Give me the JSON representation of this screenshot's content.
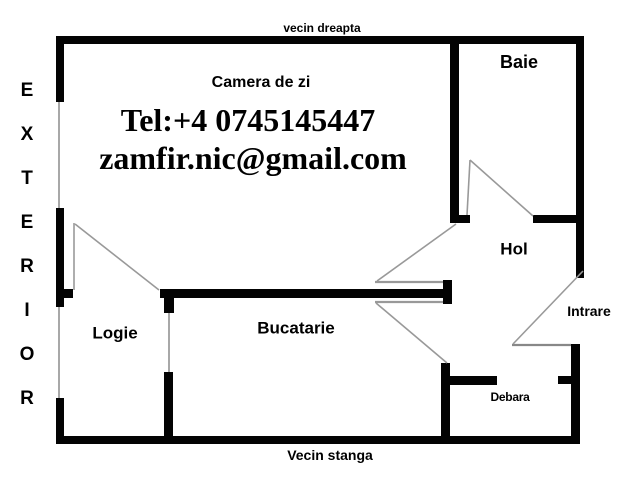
{
  "labels": {
    "neighbor_top": "vecin dreapta",
    "neighbor_bottom": "Vecin stanga",
    "entrance": "Intrare"
  },
  "exterior_letters": [
    "E",
    "X",
    "T",
    "E",
    "R",
    "I",
    "O",
    "R"
  ],
  "rooms": {
    "living": "Camera de zi",
    "bath": "Baie",
    "hall": "Hol",
    "loggia": "Logie",
    "kitchen": "Bucatarie",
    "pantry": "Debara"
  },
  "contact": {
    "phone": "Tel:+4 0745145447",
    "email": "zamfir.nic@gmail.com"
  },
  "colors": {
    "wall": "#030303",
    "window_line": "#a8a8a8",
    "door_line": "#999999",
    "text": "#000000",
    "background": "#ffffff"
  }
}
